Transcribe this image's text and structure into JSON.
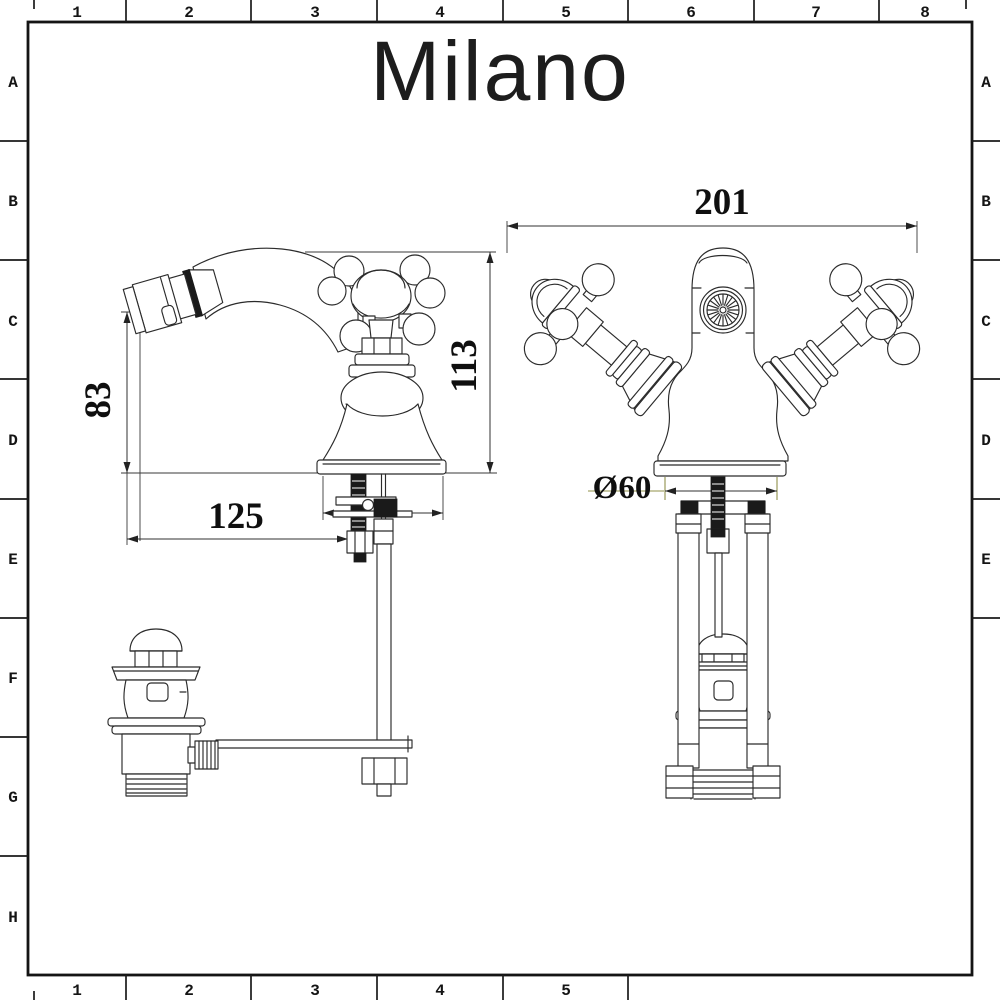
{
  "brand": {
    "logo_text": "Milano"
  },
  "frame": {
    "top_columns": [
      "1",
      "2",
      "3",
      "4",
      "5",
      "6",
      "7",
      "8"
    ],
    "bottom_columns": [
      "1",
      "2",
      "3",
      "4",
      "5"
    ],
    "left_rows": [
      "A",
      "B",
      "C",
      "D",
      "E",
      "F",
      "G",
      "H"
    ],
    "right_rows": [
      "A",
      "B",
      "C",
      "D",
      "E"
    ]
  },
  "dimensions": {
    "side_view": {
      "spout_outlet_height_mm": "83",
      "overall_height_mm": "113",
      "spout_projection_mm": "125"
    },
    "front_view": {
      "overall_width_mm": "201",
      "base_diameter_mm": "Ø60"
    }
  },
  "colors": {
    "line": "#2b2b2b",
    "dimension_accent": "#90904a",
    "background": "#ffffff"
  }
}
